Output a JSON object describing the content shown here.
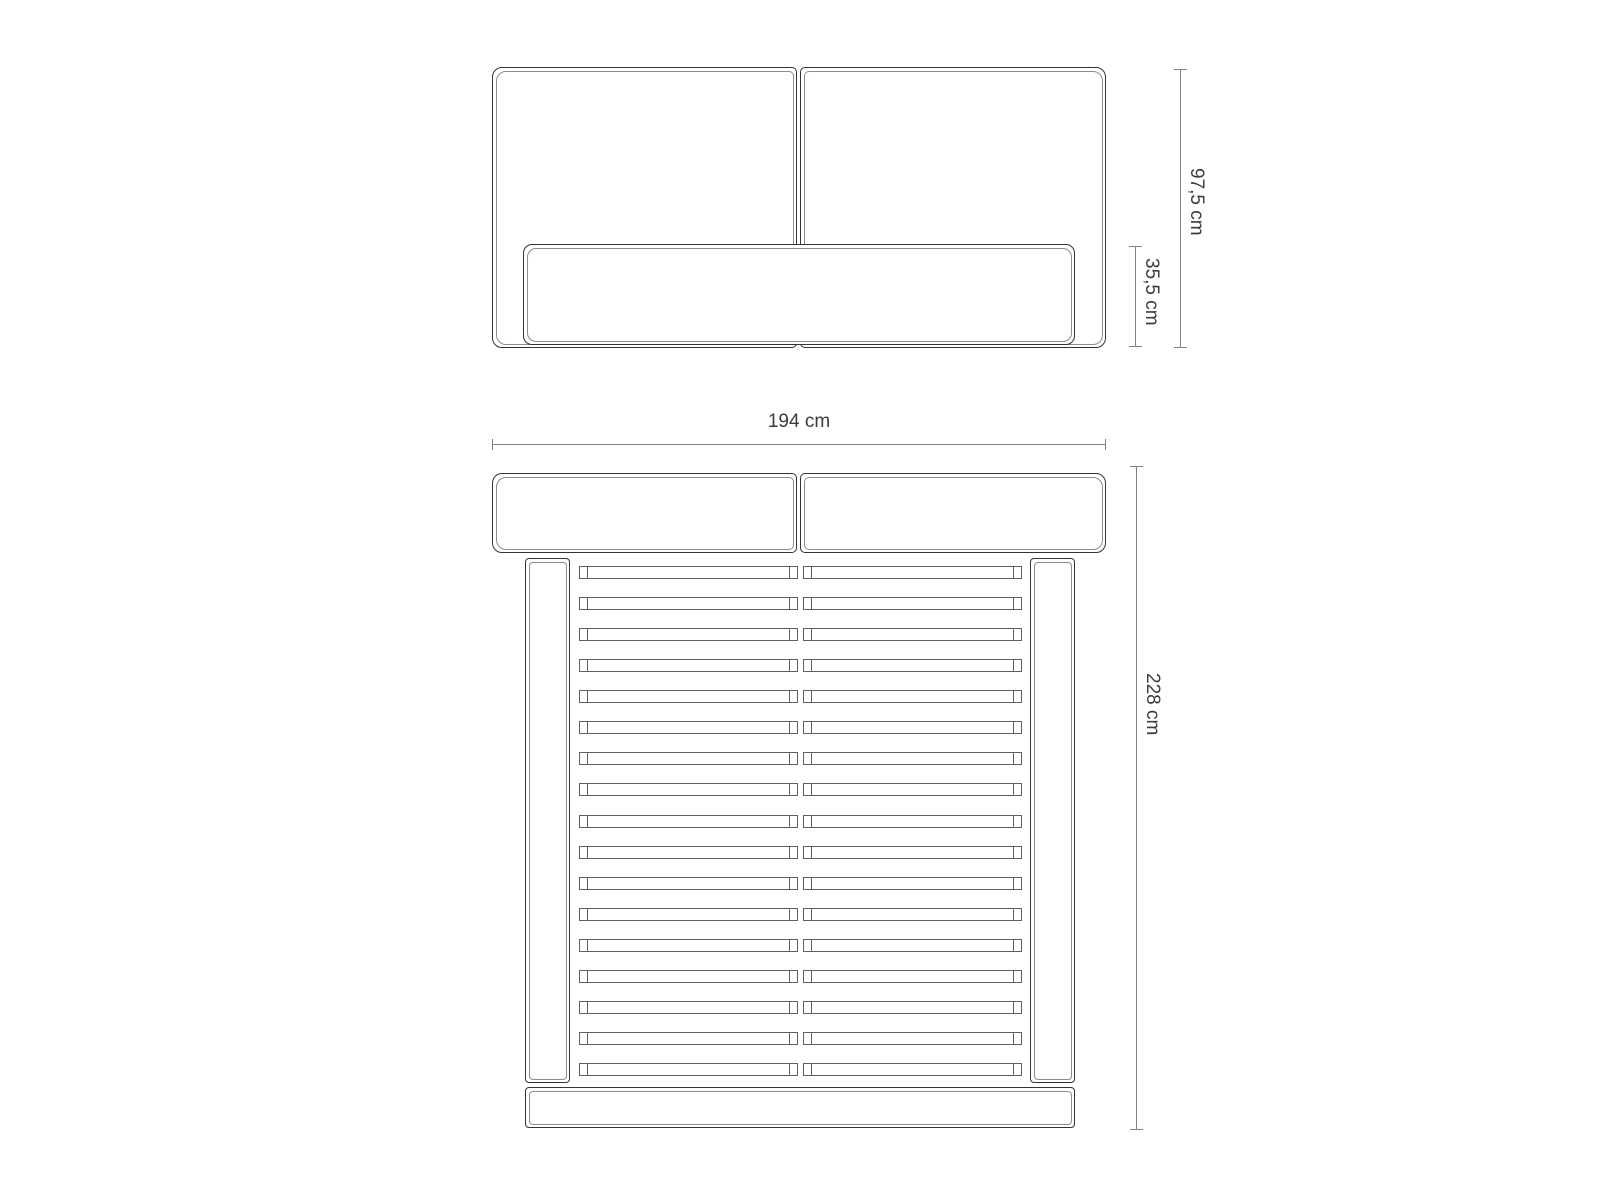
{
  "front_view": {
    "dim_total_height": "97,5 cm",
    "dim_rail_height": "35,5 cm"
  },
  "plan_view": {
    "dim_width": "194 cm",
    "dim_length": "228 cm",
    "slat_rows": 17
  },
  "colors": {
    "outline": "#343434",
    "inner_line": "#8c8c8c",
    "slat_line": "#606060",
    "dimension_line": "#828282",
    "text": "#3c3c3c",
    "background": "#ffffff"
  }
}
